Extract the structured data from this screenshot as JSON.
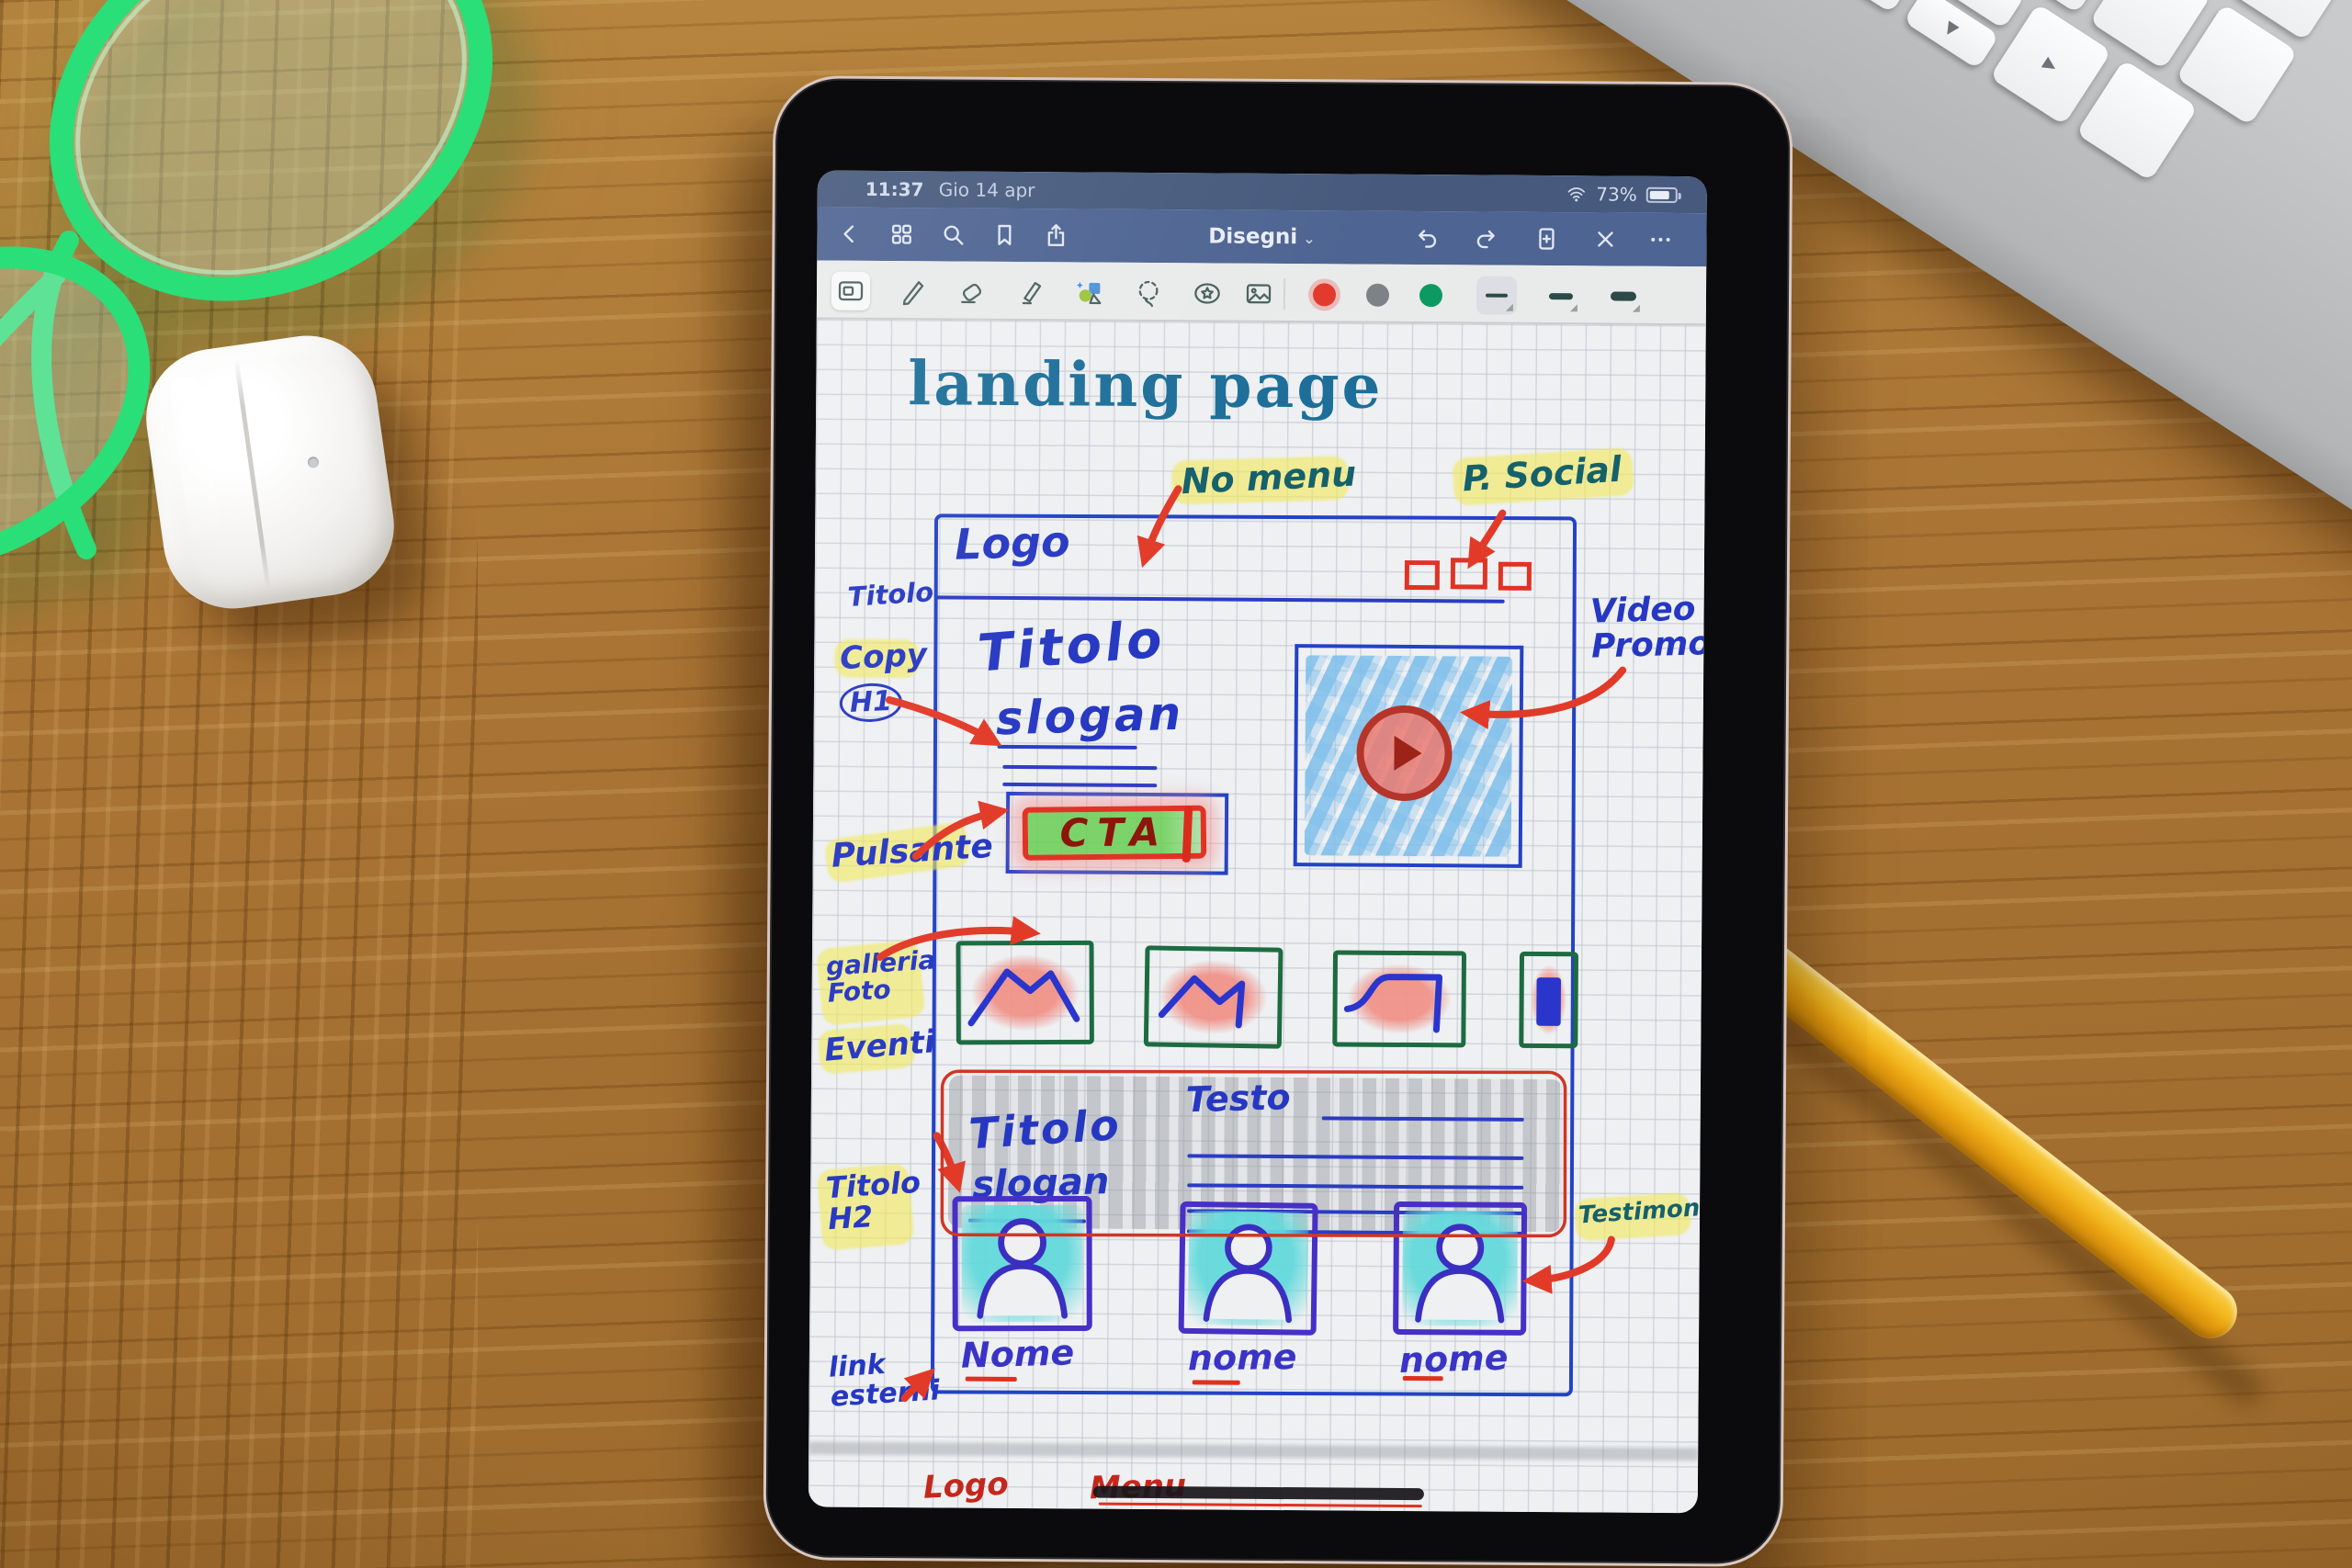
{
  "keyboard": {
    "control_key_symbol": "^",
    "control_key_label": "control",
    "arrows": {
      "up": "▲",
      "down": "▼",
      "left": "◀",
      "right": "▶"
    }
  },
  "tablet": {
    "status_bar": {
      "time": "11:37",
      "date": "Gio 14 apr",
      "battery_percent": "73%"
    },
    "nav_bar": {
      "title": "Disegni",
      "chevron": "⌄"
    },
    "toolbar": {
      "swatch_colors": [
        "#e23a2c",
        "#7d8287",
        "#0d9a62"
      ]
    },
    "canvas": {
      "page_title": "landing page",
      "ink_colors": {
        "blue": "#2638c2",
        "red": "#df3120",
        "teal_title": "#1d6f99",
        "green_box": "#1d6b40",
        "purple": "#4630c6",
        "dark_red": "#8c150c",
        "highlight_yellow": "#f0e95a"
      },
      "annotations": {
        "no_menu": "No menu",
        "p_social": "P. Social",
        "titolo_side": "Titolo",
        "copy": "Copy",
        "h1": "H1",
        "pulsante": "Pulsante",
        "video_line1": "Video",
        "video_line2": "Promo",
        "galleria_line1": "galleria",
        "galleria_line2": "Foto",
        "eventi": "Eventi",
        "titolo_h2_line1": "Titolo",
        "titolo_h2_line2": "H2",
        "testimony": "Testimony",
        "link_line1": "link",
        "link_line2": "esterni"
      },
      "wireframe": {
        "logo": "Logo",
        "hero_title": "Titolo",
        "hero_subtitle": "slogan",
        "cta": "CTA",
        "mid_title": "Titolo",
        "mid_subtitle": "slogan",
        "testo": "Testo",
        "nome_1": "Nome",
        "nome_2": "nome",
        "nome_3": "nome",
        "footer_logo": "Logo",
        "footer_menu": "Menu"
      }
    }
  }
}
